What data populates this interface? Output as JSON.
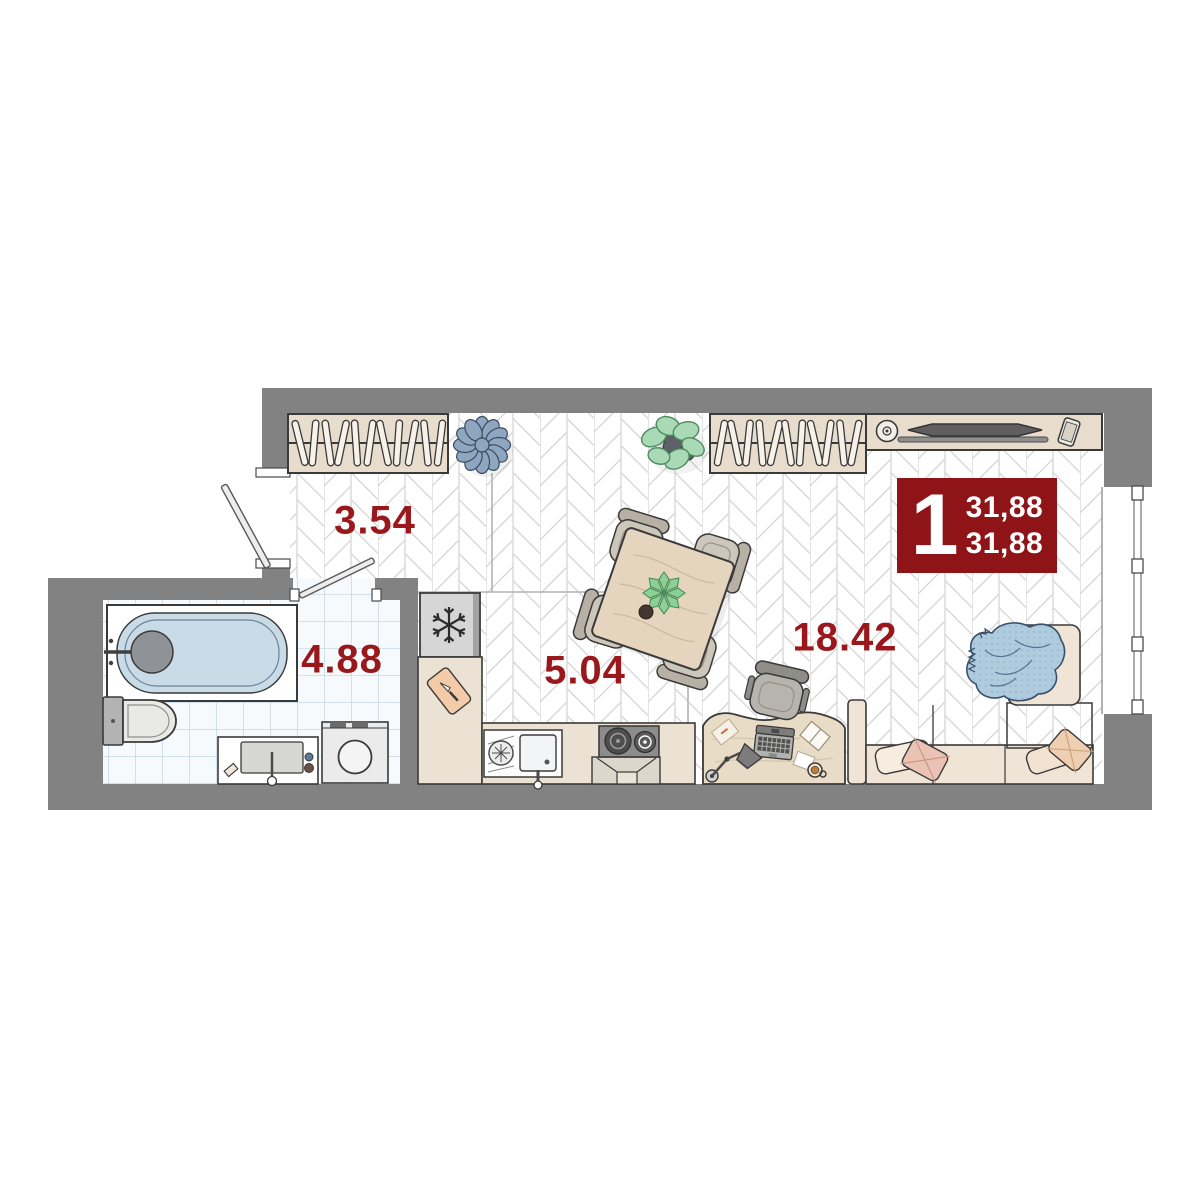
{
  "floor_plan": {
    "unit_badge": {
      "rooms_count": "1",
      "total_area": "31,88",
      "living_area": "31,88"
    },
    "rooms": [
      {
        "name": "hallway",
        "area": "3.54"
      },
      {
        "name": "bathroom",
        "area": "4.88"
      },
      {
        "name": "kitchen",
        "area": "5.04"
      },
      {
        "name": "living-room",
        "area": "18.42"
      }
    ],
    "colors": {
      "accent_red": "#8e1418",
      "label_red": "#9a171b",
      "wall_gray": "#828282",
      "floor_line_gray": "#d5d5d5",
      "tile_line_blue": "#bed3e3",
      "furniture_beige": "#e8dccd",
      "sofa_beige": "#efe4d6",
      "blanket_blue": "#afcbde",
      "pouf_blue": "#8fa6c0",
      "plant_green": "#a9dab5",
      "bathtub_blue": "#c9dbe7"
    }
  }
}
